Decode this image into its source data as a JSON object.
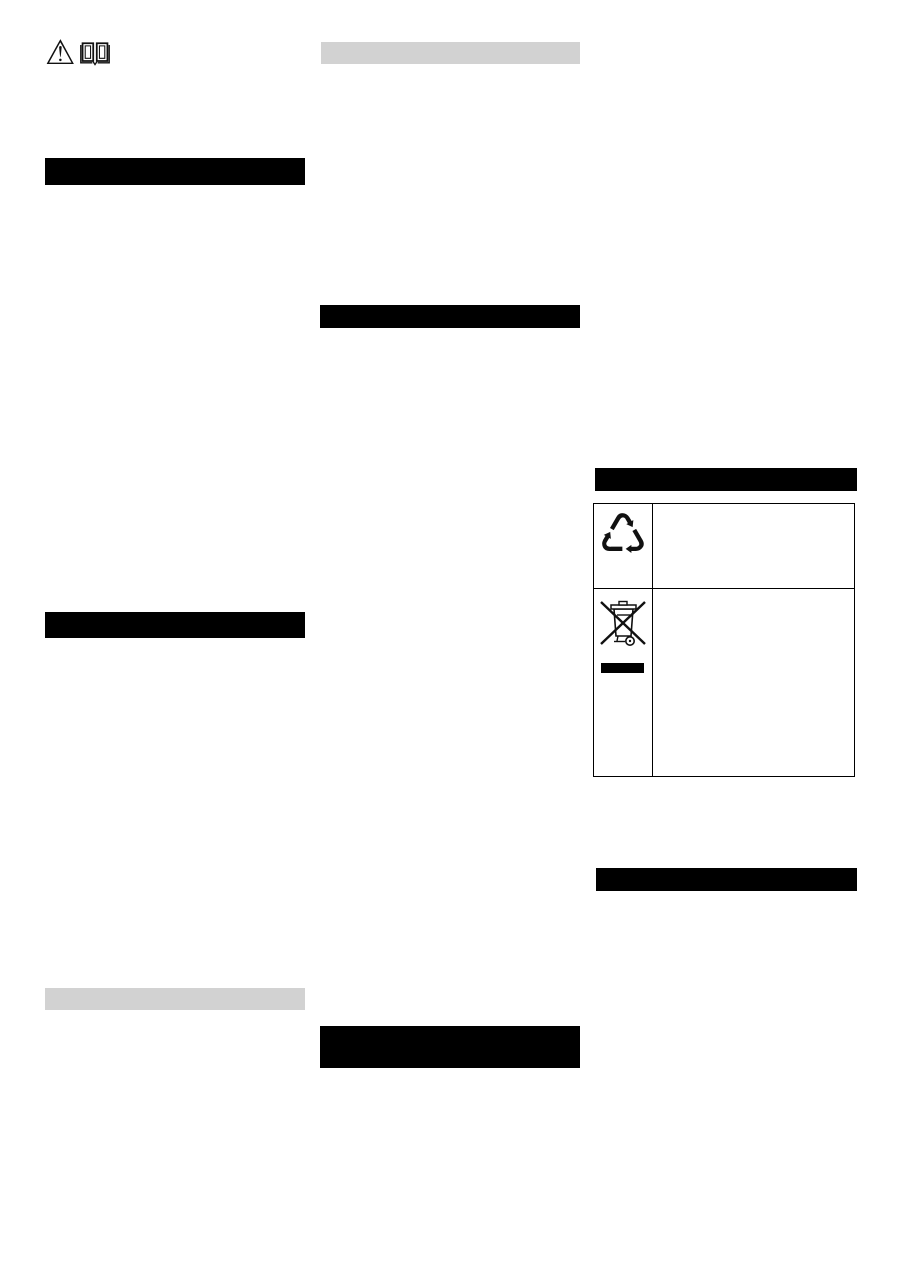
{
  "page": {
    "background_color": "#ffffff"
  },
  "colors": {
    "page_bg": "#ffffff",
    "heading_bar": "#000000",
    "subheading_bar": "#d2d2d2",
    "table_border": "#000000",
    "icon_ink": "#111111"
  },
  "top_icons": {
    "warning_glyph": "⚠",
    "warning_icon": "warning-triangle-icon",
    "manual_icon": "open-book-icon"
  },
  "redacted_bars": [
    {
      "id": "left-heading-1",
      "column": "left",
      "tone": "black"
    },
    {
      "id": "left-heading-2",
      "column": "left",
      "tone": "black"
    },
    {
      "id": "left-subheading",
      "column": "left",
      "tone": "gray"
    },
    {
      "id": "middle-subheading",
      "column": "middle",
      "tone": "gray"
    },
    {
      "id": "middle-heading-1",
      "column": "middle",
      "tone": "black"
    },
    {
      "id": "middle-heading-2",
      "column": "middle",
      "tone": "black"
    },
    {
      "id": "right-heading-1",
      "column": "right",
      "tone": "black"
    },
    {
      "id": "right-heading-2",
      "column": "right",
      "tone": "black"
    }
  ],
  "symbols_table": {
    "rows": [
      {
        "symbol": "recycling",
        "glyph": "♺"
      },
      {
        "symbol": "weee-crossed-out-wheeled-bin-with-bar",
        "glyph": ""
      }
    ]
  }
}
